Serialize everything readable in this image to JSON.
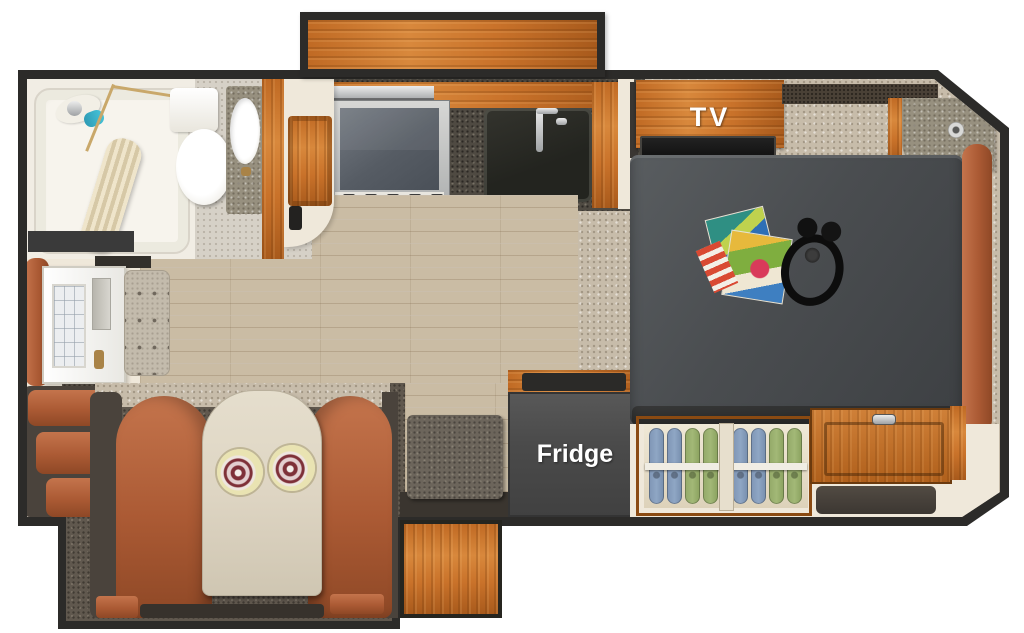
{
  "labels": {
    "tv": "TV",
    "fridge": "Fridge"
  },
  "palette": {
    "outline": "#2c2b29",
    "wood": "#c9752e",
    "wood_dark": "#9c5517",
    "cream": "#efe8da",
    "carpet": "#c7bcaa",
    "carpet_dark": "#60584e",
    "granite": "#4f4a42",
    "granite_light": "#97907f",
    "floor": "#cabca4",
    "mattress": "#4b4e51",
    "cushion": "#b2613a",
    "table": "#ded5c3",
    "fridge": "#4b4b4b",
    "hanger_blue": "#8fa6c4",
    "hanger_green": "#a2b877",
    "label_text": "#ffffff"
  }
}
